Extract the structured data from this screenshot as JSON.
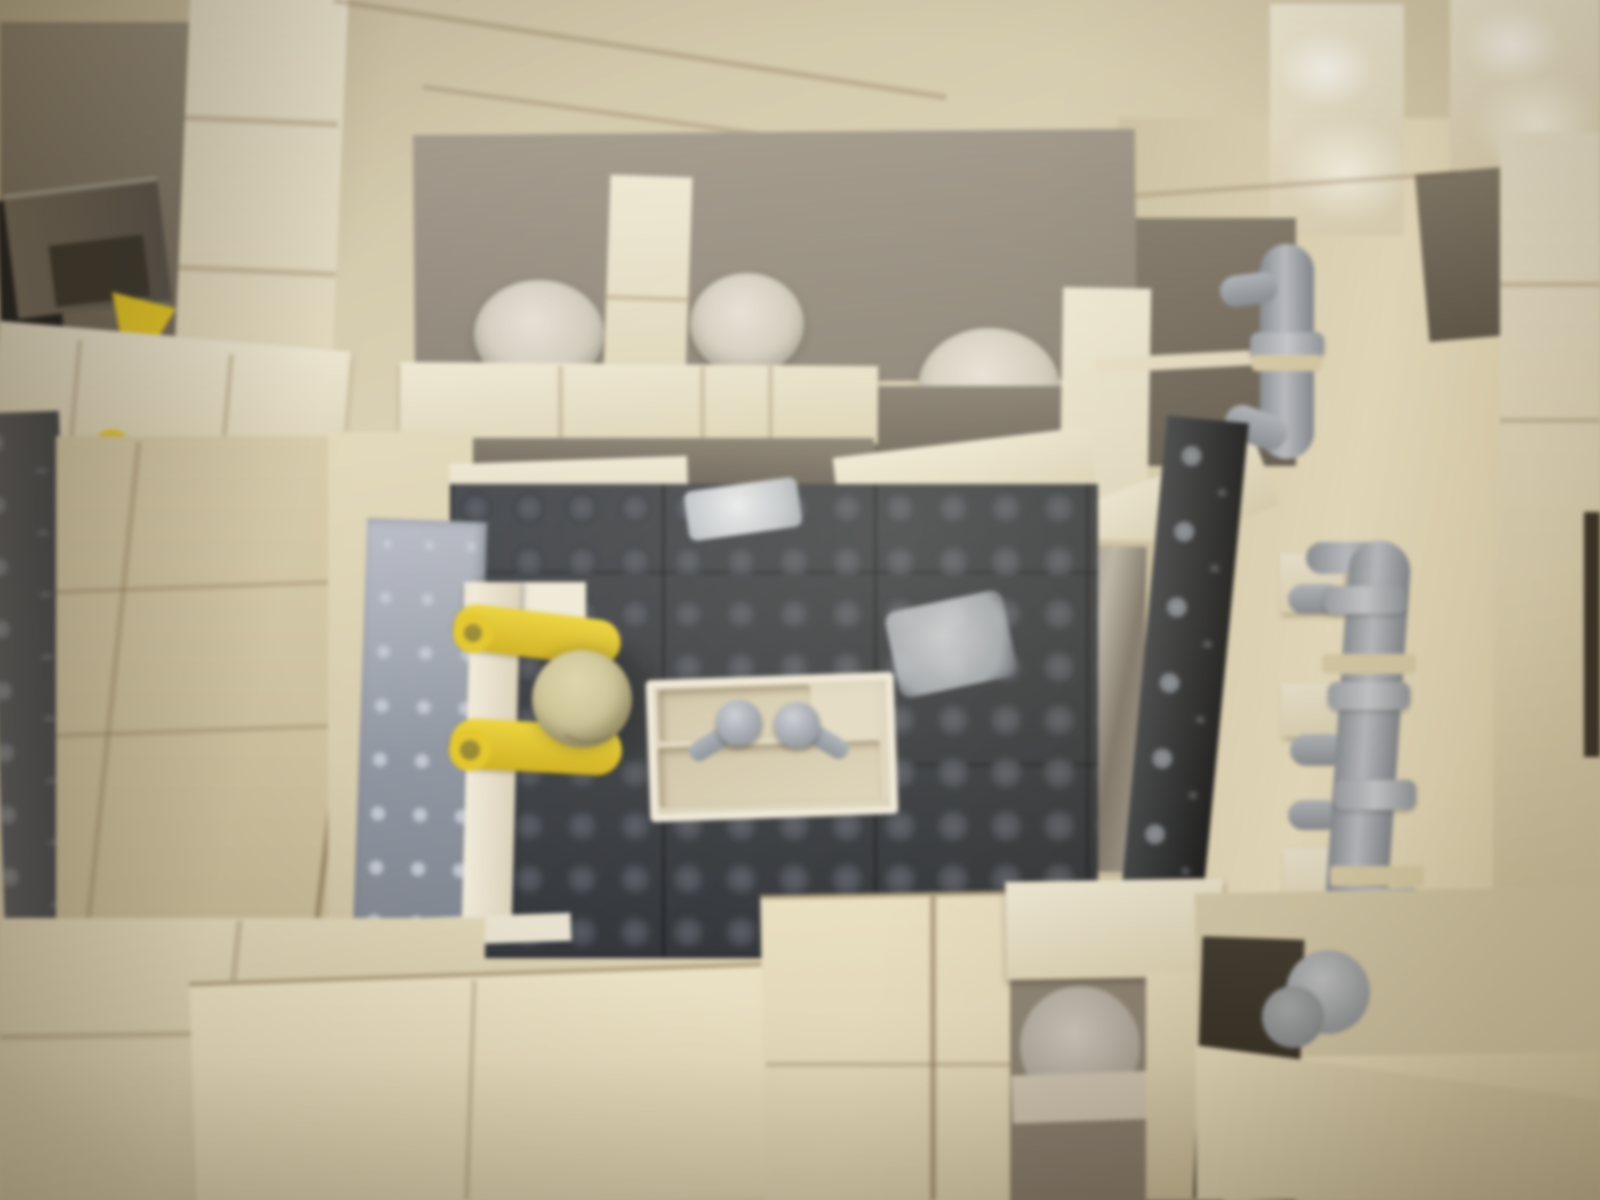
{
  "scene": {
    "subject": "lego-bathroom-interior-overhead",
    "description": "Top-down photograph of a LEGO bathroom build: cream brick walls seen from above, a dark gray studded floor plate, a yellow minifigure at a doorway with a gray studded door panel, a white sink unit with two gray taps, toilet stalls with round white bowls, gray pipe and tap assemblies along the right wall, and a small hallway at lower right",
    "medium": "photograph"
  },
  "palette": {
    "cream_bright": "#f0e9d4",
    "cream_mid": "#ddd2b2",
    "cream_shadow": "#c0b38e",
    "taupe_shadow": "#6f665a",
    "floor_dark": "#34373d",
    "stud_gray": "#4a4e56",
    "pipe_gray": "#9aa0ab",
    "door_blue_gray": "#9ca2ae",
    "minifig_yellow": "#e6c71f",
    "minifig_head": "#cbc190",
    "porcelain_white": "#e6e1d5",
    "dark_opening": "#1b1c20",
    "glass_reflection": "#e8ebef"
  },
  "objects": [
    {
      "name": "minifig",
      "color": "yellow",
      "pose": "standing at open door, seen from directly above"
    },
    {
      "name": "door-panel",
      "color": "light blue-gray",
      "detail": "studded plate door, ajar"
    },
    {
      "name": "sink-unit",
      "color": "white",
      "detail": "two gray swivel taps"
    },
    {
      "name": "toilet-bowl",
      "count": 3,
      "color": "white",
      "detail": "round bowls in stalls"
    },
    {
      "name": "pipe-assembly",
      "count": 2,
      "color": "gray",
      "detail": "vertical pipes with collars and tap nozzles on right wall"
    },
    {
      "name": "floor-plate",
      "color": "dark bluish gray",
      "detail": "studded LEGO baseplate"
    },
    {
      "name": "toilet-paper-roll",
      "color": "white",
      "detail": "in alcove at lower right of room"
    },
    {
      "name": "flash-reflection",
      "count": 2,
      "detail": "bright silver glare patches on floor plates"
    }
  ]
}
